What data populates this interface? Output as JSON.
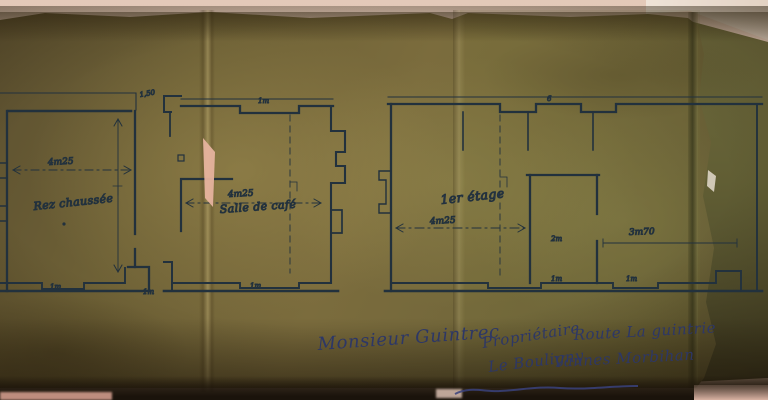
{
  "colors": {
    "table": "#d8bcab",
    "paper": "#7a6b3c",
    "paper_shadow": "#3e351e",
    "second_sheet": "#67653a",
    "corner_light": "#e9ded2",
    "ink": "#22313d",
    "ink_blue": "#2d3766",
    "tear_patch": "#e6b39e"
  },
  "plans": {
    "left": {
      "room_label": "Rez chaussée",
      "width_dim": "4m25",
      "door_dim": "1m"
    },
    "middle": {
      "corner_dim": "1,50",
      "top_door_dim": "1m",
      "width_dim": "4m25",
      "room_label": "Salle de café",
      "bottom_door_dim": "1m"
    },
    "right": {
      "floor_label": "1er étage",
      "width_dim": "4m25",
      "center_dim": "2m",
      "right_dim": "3m70",
      "top_door_dim": "6",
      "bottom_door_dim": "1m",
      "bottom_door_dim2": "1m"
    }
  },
  "annotations": {
    "client": "Monsieur Guintrec",
    "owner_title": "Propriétaire",
    "address_line1": "Route La guintrie",
    "address_line2": "Le Bouligny",
    "address_line3": "Vannes Morbihan"
  }
}
